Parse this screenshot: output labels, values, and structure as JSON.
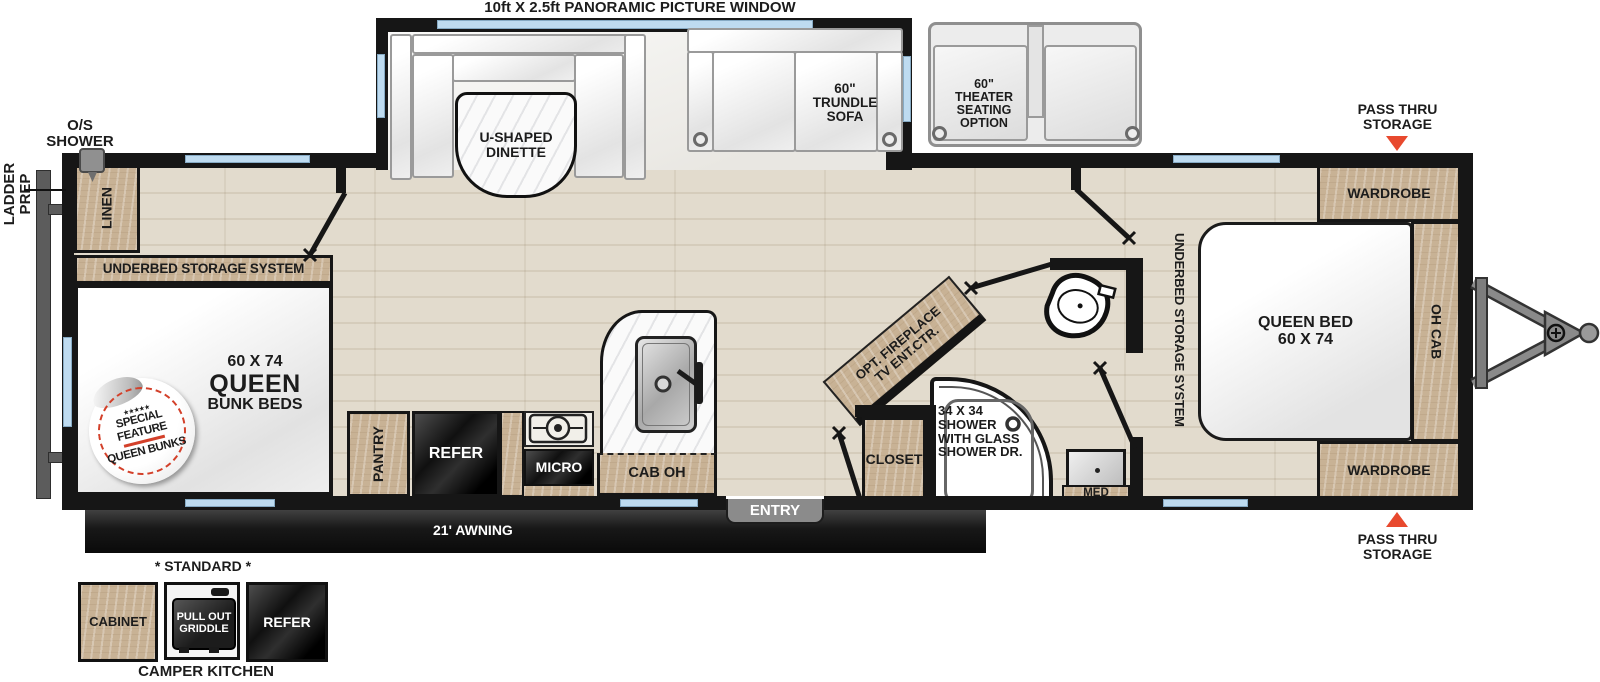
{
  "colors": {
    "accent_red": "#e8492e",
    "wall": "#161616",
    "wood": "#c8b295",
    "window_blue": "#bedbf0"
  },
  "exterior": {
    "panoramic": "10ft X 2.5ft PANORAMIC PICTURE WINDOW",
    "os_shower": "O/S\nSHOWER",
    "ladder_prep": "LADDER\nPREP",
    "pass_thru_top": "PASS THRU\nSTORAGE",
    "pass_thru_bottom": "PASS THRU\nSTORAGE",
    "awning": "21' AWNING",
    "entry": "ENTRY"
  },
  "slideout": {
    "dinette": "U-SHAPED\nDINETTE",
    "trundle_sofa": "60\"\nTRUNDLE\nSOFA"
  },
  "theater": {
    "label": "60\"\nTHEATER\nSEATING\nOPTION"
  },
  "bunk_room": {
    "linen": "LINEN",
    "underbed": "UNDERBED STORAGE SYSTEM",
    "size": "60 X 74",
    "name": "QUEEN",
    "sub": "BUNK BEDS",
    "badge_stars": "★★★★★",
    "badge_top": "SPECIAL FEATURE",
    "badge_bottom": "QUEEN BUNKS"
  },
  "kitchen": {
    "pantry": "PANTRY",
    "refer": "REFER",
    "micro": "MICRO",
    "cab_oh": "CAB OH"
  },
  "living": {
    "fireplace": "OPT. FIREPLACE",
    "tv": "TV ENT.CTR.",
    "closet": "CLOSET"
  },
  "bathroom": {
    "shower": "34 X 34\nSHOWER\nWITH GLASS\nSHOWER DR.",
    "med": "MED"
  },
  "bedroom": {
    "wardrobe_top": "WARDROBE",
    "wardrobe_bottom": "WARDROBE",
    "oh_cab": "OH CAB",
    "bed": "QUEEN BED\n60 X 74",
    "underbed": "UNDERBED STORAGE SYSTEM"
  },
  "camper_kitchen": {
    "standard": "* STANDARD *",
    "cabinet": "CABINET",
    "griddle": "PULL OUT\nGRIDDLE",
    "refer": "REFER",
    "title": "CAMPER KITCHEN"
  }
}
